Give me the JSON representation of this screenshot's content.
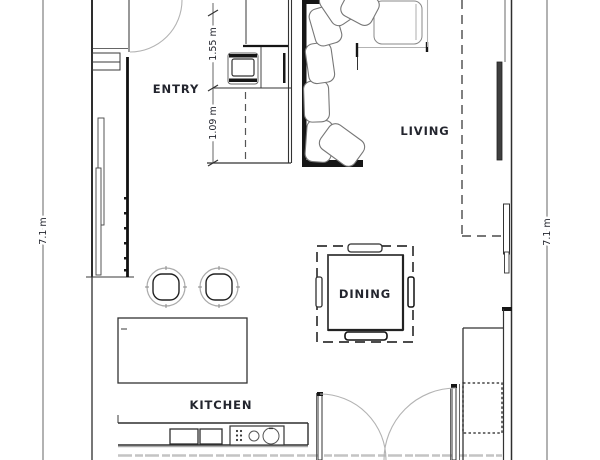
{
  "labels": {
    "entry": "ENTRY",
    "living": "LIVING",
    "dining": "DINING",
    "kitchen": "KITCHEN"
  },
  "dimensions": {
    "overall_left": "7.1 m",
    "overall_right": "7.1 m",
    "entry_depth_upper": "1.55 m",
    "entry_depth_lower": "1.09 m"
  },
  "colors": {
    "background": "#ffffff",
    "wall_line": "#2e2e2e",
    "bold_wall": "#161616",
    "door_swing": "#b3b3b3",
    "dashed_line": "#4a4a4a",
    "label_text": "#23252e"
  }
}
